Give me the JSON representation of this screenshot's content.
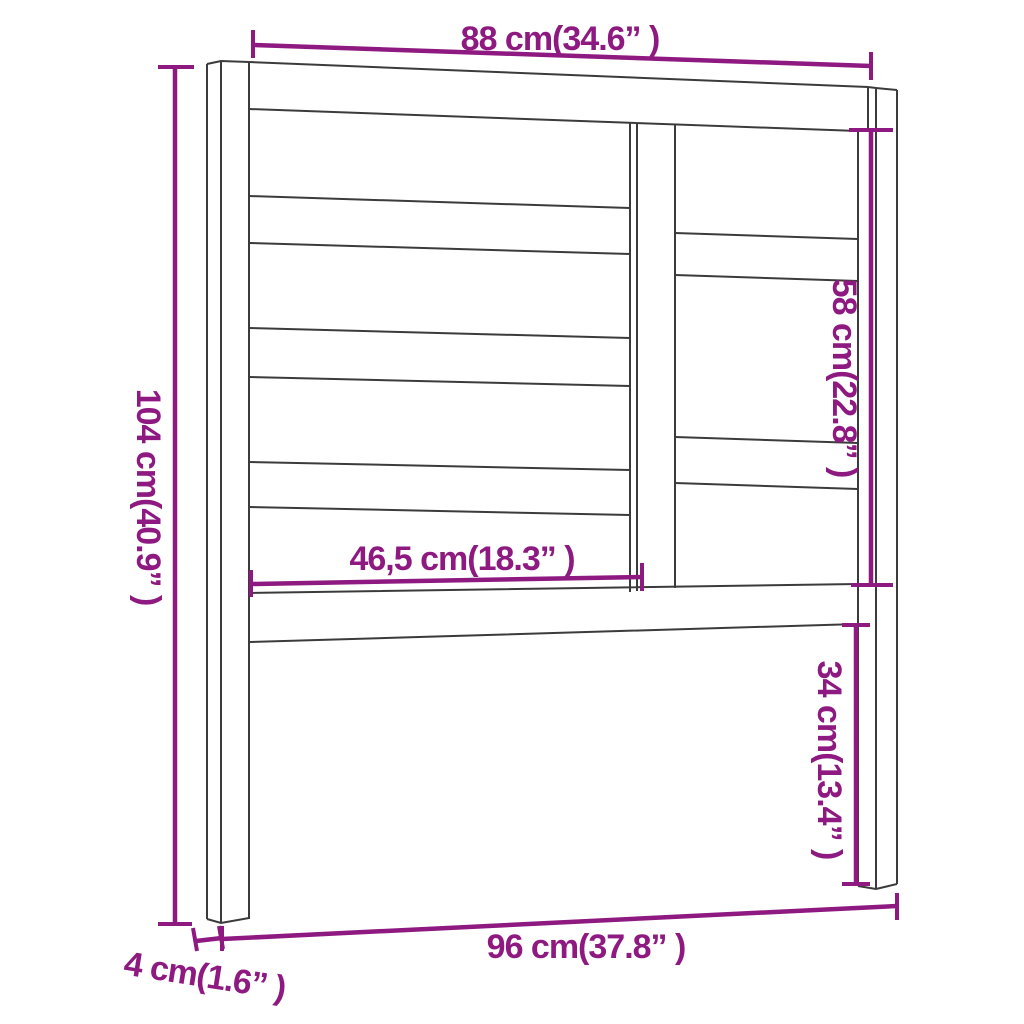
{
  "diagram": {
    "kind": "furniture-dimension-drawing",
    "subject": "slatted headboard front view",
    "colors": {
      "dimension_accent": "#8E1980",
      "outline": "#3b3b3b",
      "background": "#ffffff"
    }
  },
  "dimensions": {
    "width_top": "88 cm(34.6” )",
    "height_left": "104 cm(40.9” )",
    "slat_length": "46,5 cm(18.3” )",
    "height_right_upper": "58 cm(22.8” )",
    "height_right_lower": "34 cm(13.4” )",
    "width_bottom": "96 cm(37.8” )",
    "leg_depth": "4 cm(1.6” )"
  }
}
